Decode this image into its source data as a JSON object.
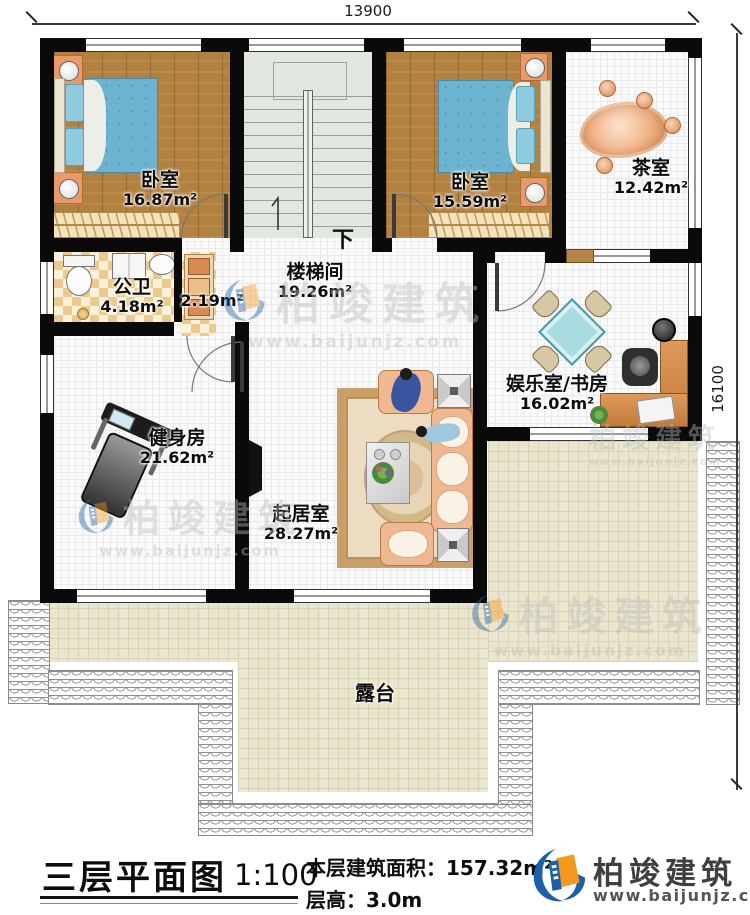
{
  "dimensions": {
    "width": "13900",
    "height": "16100"
  },
  "rooms": {
    "bedroom_left": {
      "name": "卧室",
      "area": "16.87m²"
    },
    "bedroom_right": {
      "name": "卧室",
      "area": "15.59m²"
    },
    "tea_room": {
      "name": "茶室",
      "area": "12.42m²"
    },
    "bathroom": {
      "name": "公卫",
      "area": "4.18m²"
    },
    "closet": {
      "area": "2.19m²"
    },
    "stair_hall": {
      "name": "楼梯间",
      "area": "19.26m²"
    },
    "entertainment": {
      "name": "娱乐室/书房",
      "area": "16.02m²"
    },
    "gym": {
      "name": "健身房",
      "area": "21.62m²"
    },
    "living": {
      "name": "起居室",
      "area": "28.27m²"
    },
    "terrace": {
      "name": "露台"
    }
  },
  "stairs": {
    "direction_label": "下"
  },
  "title_block": {
    "title": "三层平面图",
    "scale": "1:100",
    "area_label": "本层建筑面积：",
    "area_value": "157.32m²",
    "height_label": "层高：",
    "height_value": "3.0m"
  },
  "brand": {
    "name": "柏竣建筑",
    "website": "www.baijunjz.com"
  },
  "watermark": {
    "text": "柏竣建筑",
    "website": "www.baijunjz.com"
  },
  "colors": {
    "wall": "#0a0a0a",
    "wood_floor": "#b3813f",
    "bed": "#6db4d0",
    "sofa": "#f0b890",
    "terrace_floor": "#eae5cf",
    "brand_blue": "#1d5fa8",
    "brand_orange": "#f5991e"
  }
}
